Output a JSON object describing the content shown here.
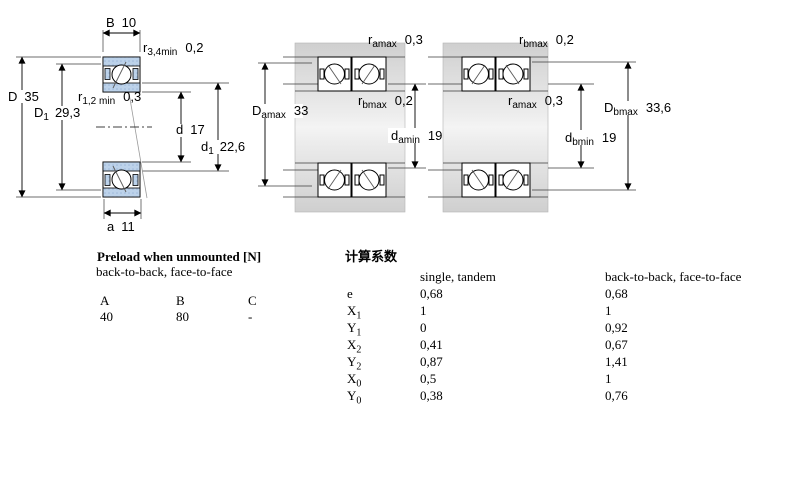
{
  "page": {
    "background": "#ffffff"
  },
  "colors": {
    "ring_fill": "#bcd2ea",
    "ring_dot": "#9db8da",
    "housing_dark": "#cfcfcf",
    "housing_light": "#f2f2f2",
    "line": "#000000"
  },
  "drawings": {
    "left": {
      "B": {
        "sym": "B",
        "val": "10"
      },
      "r34": {
        "sym": "r",
        "sub": "3,4min",
        "val": "0,2"
      },
      "D": {
        "sym": "D",
        "val": "35"
      },
      "r12": {
        "sym": "r",
        "sub": "1,2 min",
        "val": "0,3"
      },
      "D1": {
        "sym": "D",
        "sub": "1",
        "val": "29,3"
      },
      "d": {
        "sym": "d",
        "val": "17"
      },
      "d1": {
        "sym": "d",
        "sub": "1",
        "val": "22,6"
      },
      "a": {
        "sym": "a",
        "val": "11"
      }
    },
    "middle": {
      "ramax": {
        "sym": "r",
        "sub": "amax",
        "val": "0,3"
      },
      "rbmax": {
        "sym": "r",
        "sub": "bmax",
        "val": "0,2"
      },
      "Damax": {
        "sym": "D",
        "sub": "amax",
        "val": "33"
      },
      "damin": {
        "sym": "d",
        "sub": "amin",
        "val": "19"
      }
    },
    "right": {
      "rbmax": {
        "sym": "r",
        "sub": "bmax",
        "val": "0,2"
      },
      "ramax": {
        "sym": "r",
        "sub": "amax",
        "val": "0,3"
      },
      "Dbmax": {
        "sym": "D",
        "sub": "bmax",
        "val": "33,6"
      },
      "dbmin": {
        "sym": "d",
        "sub": "bmin",
        "val": "19"
      }
    }
  },
  "preload": {
    "title": "Preload when unmounted [N]",
    "subtitle": "back-to-back, face-to-face",
    "columns": [
      "A",
      "B",
      "C"
    ],
    "values": [
      "40",
      "80",
      "-"
    ]
  },
  "factors": {
    "title": "计算系数",
    "col_single": "single, tandem",
    "col_paired": "back-to-back, face-to-face",
    "rows": [
      {
        "sym": "e",
        "sub": "",
        "single": "0,68",
        "paired": "0,68"
      },
      {
        "sym": "X",
        "sub": "1",
        "single": "1",
        "paired": "1"
      },
      {
        "sym": "Y",
        "sub": "1",
        "single": "0",
        "paired": "0,92"
      },
      {
        "sym": "X",
        "sub": "2",
        "single": "0,41",
        "paired": "0,67"
      },
      {
        "sym": "Y",
        "sub": "2",
        "single": "0,87",
        "paired": "1,41"
      },
      {
        "sym": "X",
        "sub": "0",
        "single": "0,5",
        "paired": "1"
      },
      {
        "sym": "Y",
        "sub": "0",
        "single": "0,38",
        "paired": "0,76"
      }
    ]
  }
}
